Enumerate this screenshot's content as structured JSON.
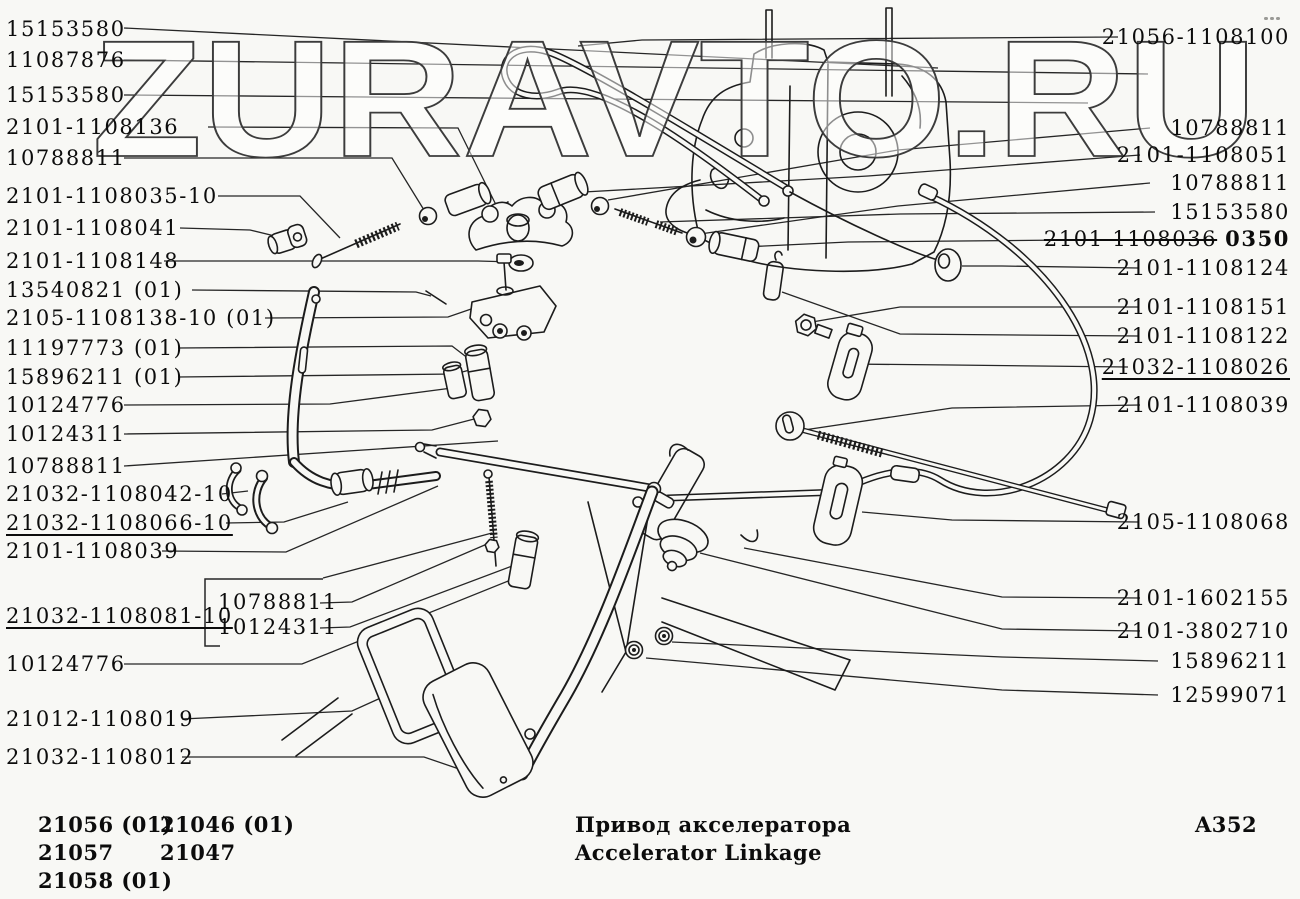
{
  "watermark": "ZURAVTO.RU",
  "left_labels": [
    "15153580",
    "11087876",
    "15153580",
    "2101-1108136",
    "10788811",
    "2101-1108035-10",
    "2101-1108041",
    "2101-1108148",
    "13540821 (01)",
    "2105-1108138-10 (01)",
    "11197773 (01)",
    "15896211 (01)",
    "10124776",
    "10124311",
    "10788811",
    "21032-1108042-10",
    "21032-1108066-10",
    "2101-1108039",
    "21032-1108081-10",
    "10124776",
    "21012-1108019",
    "21032-1108012"
  ],
  "bracket_labels": [
    "10788811",
    "10124311"
  ],
  "right_labels": [
    "21056-1108100",
    "10788811",
    "2101-1108051",
    "10788811",
    "15153580",
    "2101-1108124",
    "2101-1108151",
    "2101-1108122",
    "21032-1108026",
    "2101-1108039",
    "2105-1108068",
    "2101-1602155",
    "2101-3802710",
    "15896211",
    "12599071"
  ],
  "corrected_label": {
    "part_number": "2101-1108036",
    "stamp": "0350"
  },
  "footer": {
    "models_col1": [
      "21056 (01)",
      "21057",
      "21058 (01)"
    ],
    "models_col2": [
      "21046 (01)",
      "21047"
    ],
    "title_ru": "Привод акселератора",
    "title_en": "Accelerator Linkage",
    "page_code": "A352"
  }
}
